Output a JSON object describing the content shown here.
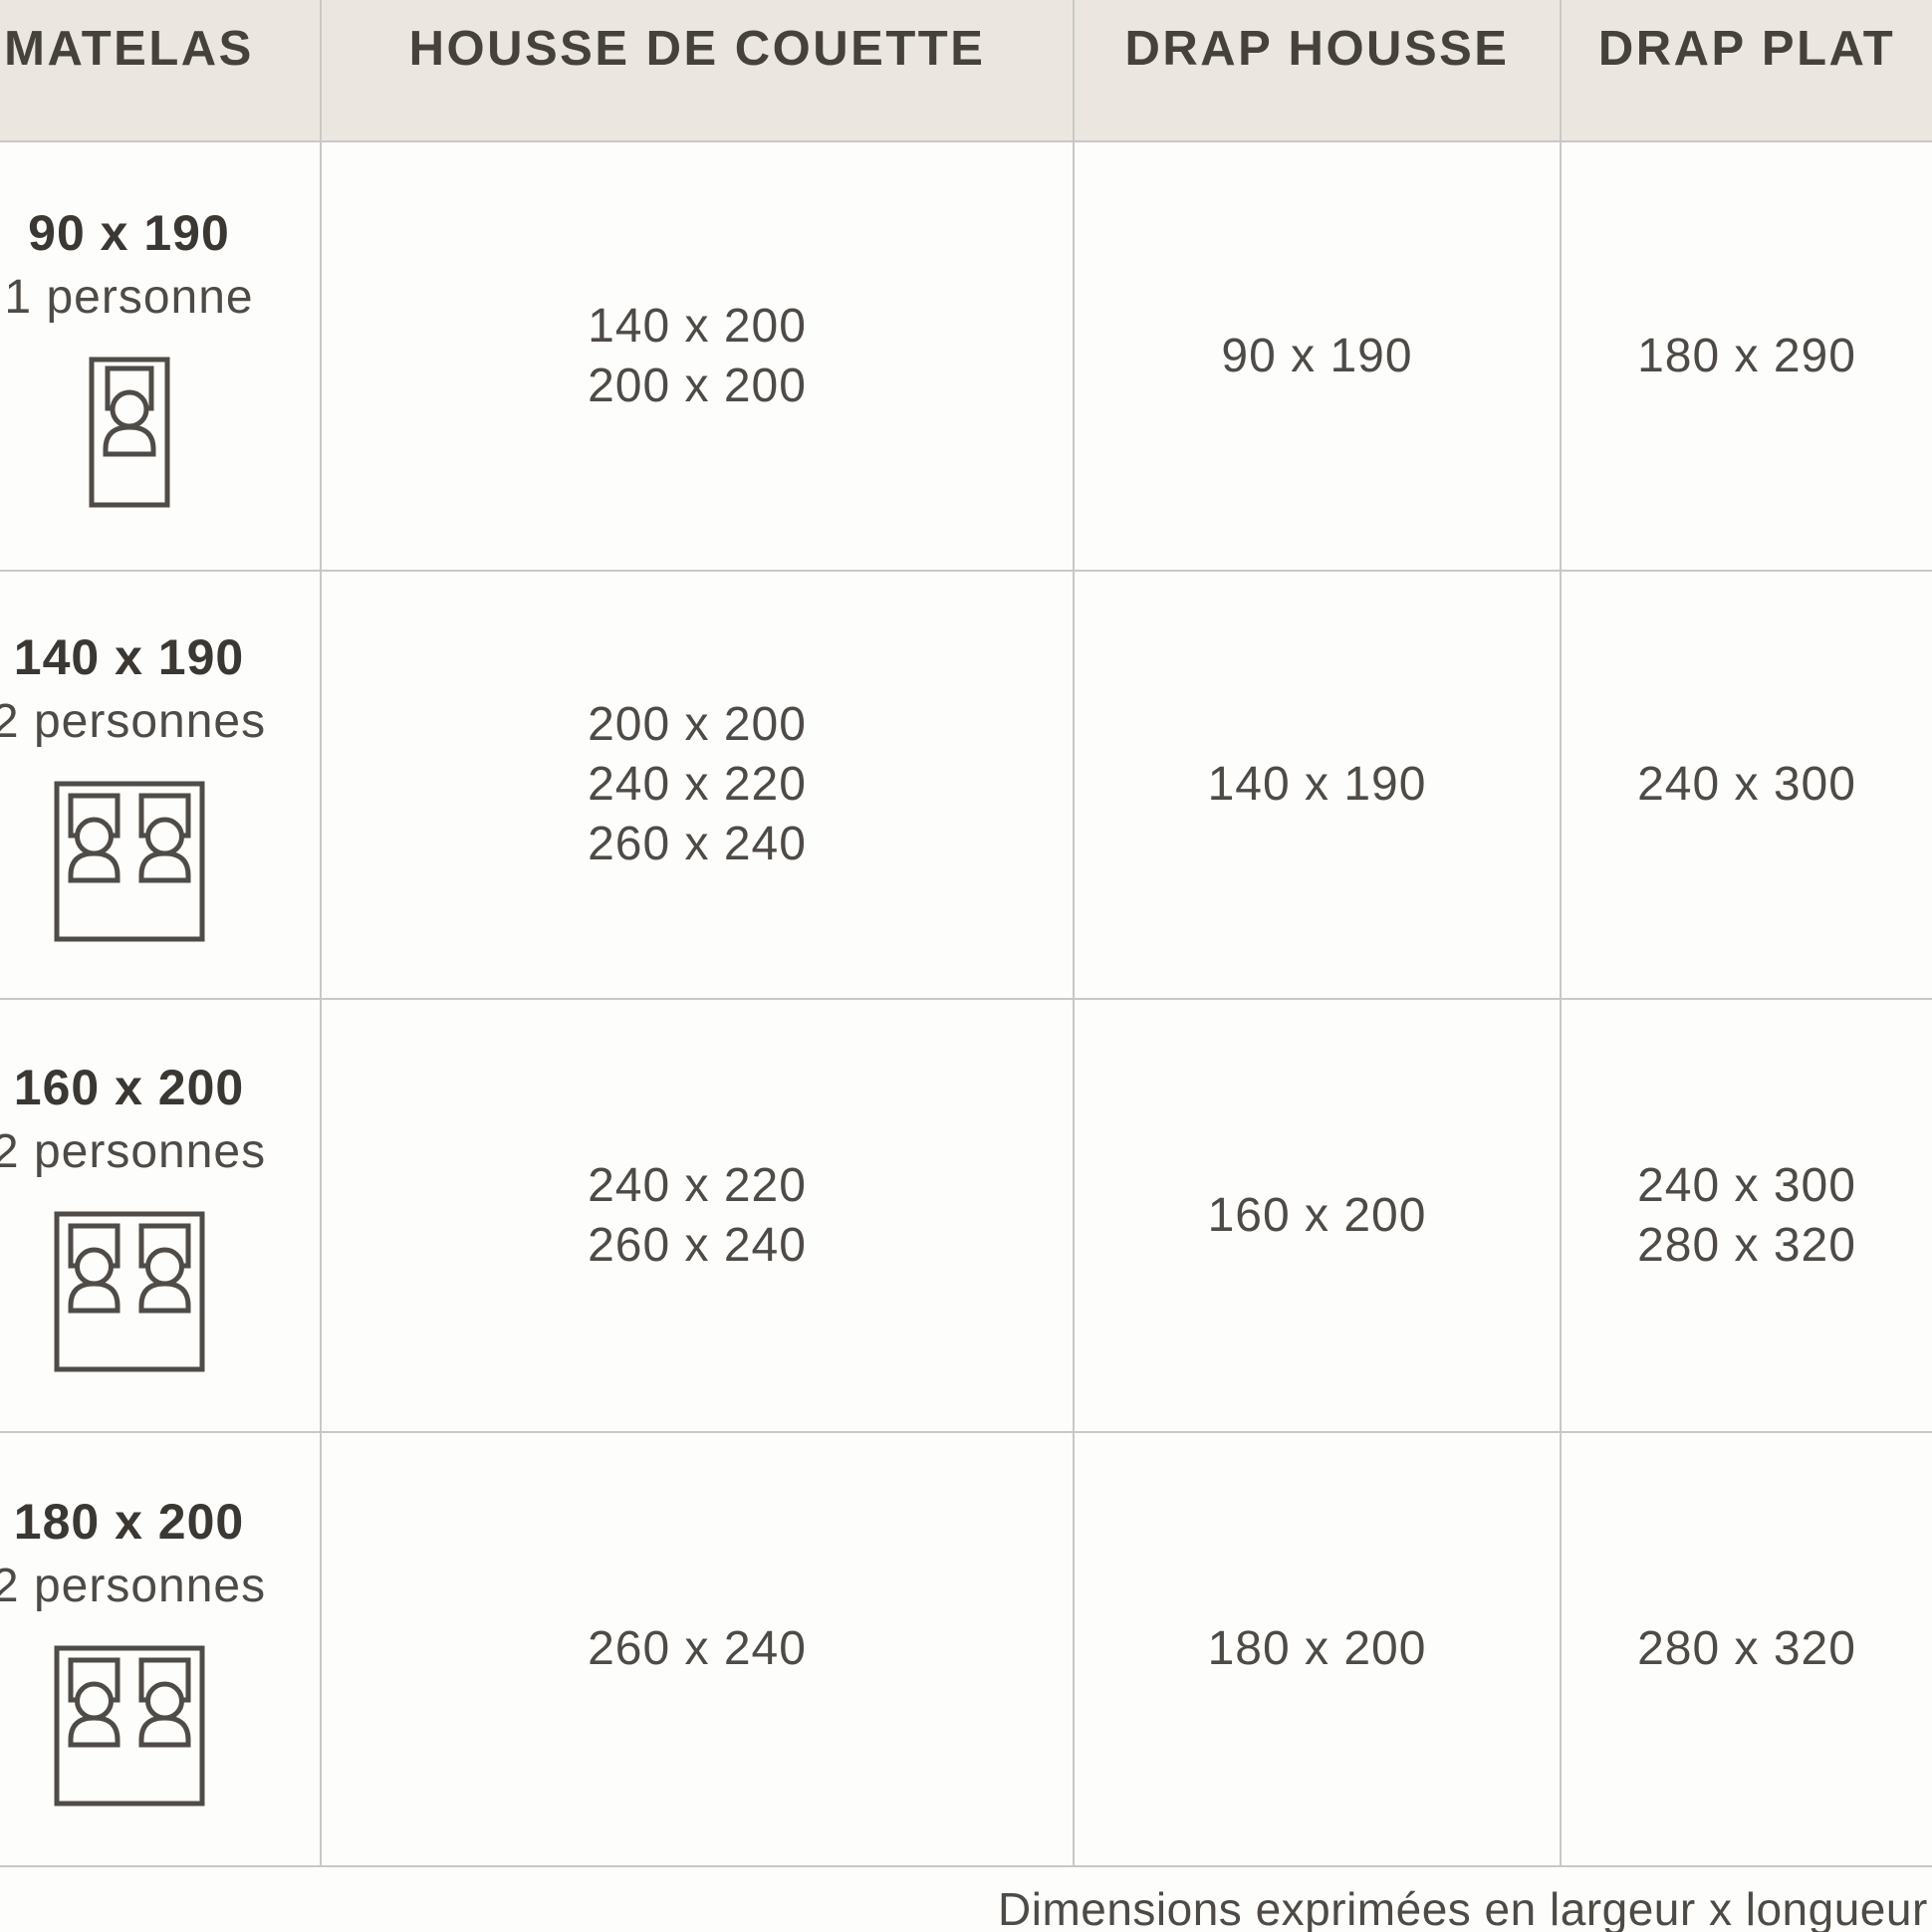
{
  "chart_data": {
    "type": "table",
    "title": "Guide des tailles de linge de lit",
    "columns": [
      "MATELAS",
      "HOUSSE DE COUETTE",
      "DRAP HOUSSE",
      "DRAP PLAT"
    ],
    "rows": [
      {
        "matelas": "90 x 190",
        "capacity": "1 personne",
        "icon": "single-bed-icon",
        "housse_de_couette": [
          "140 x 200",
          "200 x 200"
        ],
        "drap_housse": "90 x 190",
        "drap_plat": [
          "180 x 290"
        ]
      },
      {
        "matelas": "140 x 190",
        "capacity": "2 personnes",
        "icon": "double-bed-icon",
        "housse_de_couette": [
          "200 x 200",
          "240 x 220",
          "260 x 240"
        ],
        "drap_housse": "140 x 190",
        "drap_plat": [
          "240 x 300"
        ]
      },
      {
        "matelas": "160 x 200",
        "capacity": "2 personnes",
        "icon": "double-bed-icon",
        "housse_de_couette": [
          "240 x 220",
          "260 x 240"
        ],
        "drap_housse": "160 x 200",
        "drap_plat": [
          "240 x 300",
          "280 x 320"
        ]
      },
      {
        "matelas": "180 x 200",
        "capacity": "2 personnes",
        "icon": "double-bed-icon",
        "housse_de_couette": [
          "260 x 240"
        ],
        "drap_housse": "180 x 200",
        "drap_plat": [
          "280 x 320"
        ]
      }
    ],
    "footnote": "Dimensions exprimées en largeur x longueur (cm",
    "layout": {
      "grid": "on",
      "unit": "cm"
    }
  },
  "colors": {
    "header_bg": "#ebe7e0",
    "grid_line": "#c9c8c4",
    "header_text": "#45413b",
    "body_text": "#4e4b46",
    "cell_bg": "#fdfdfc"
  }
}
